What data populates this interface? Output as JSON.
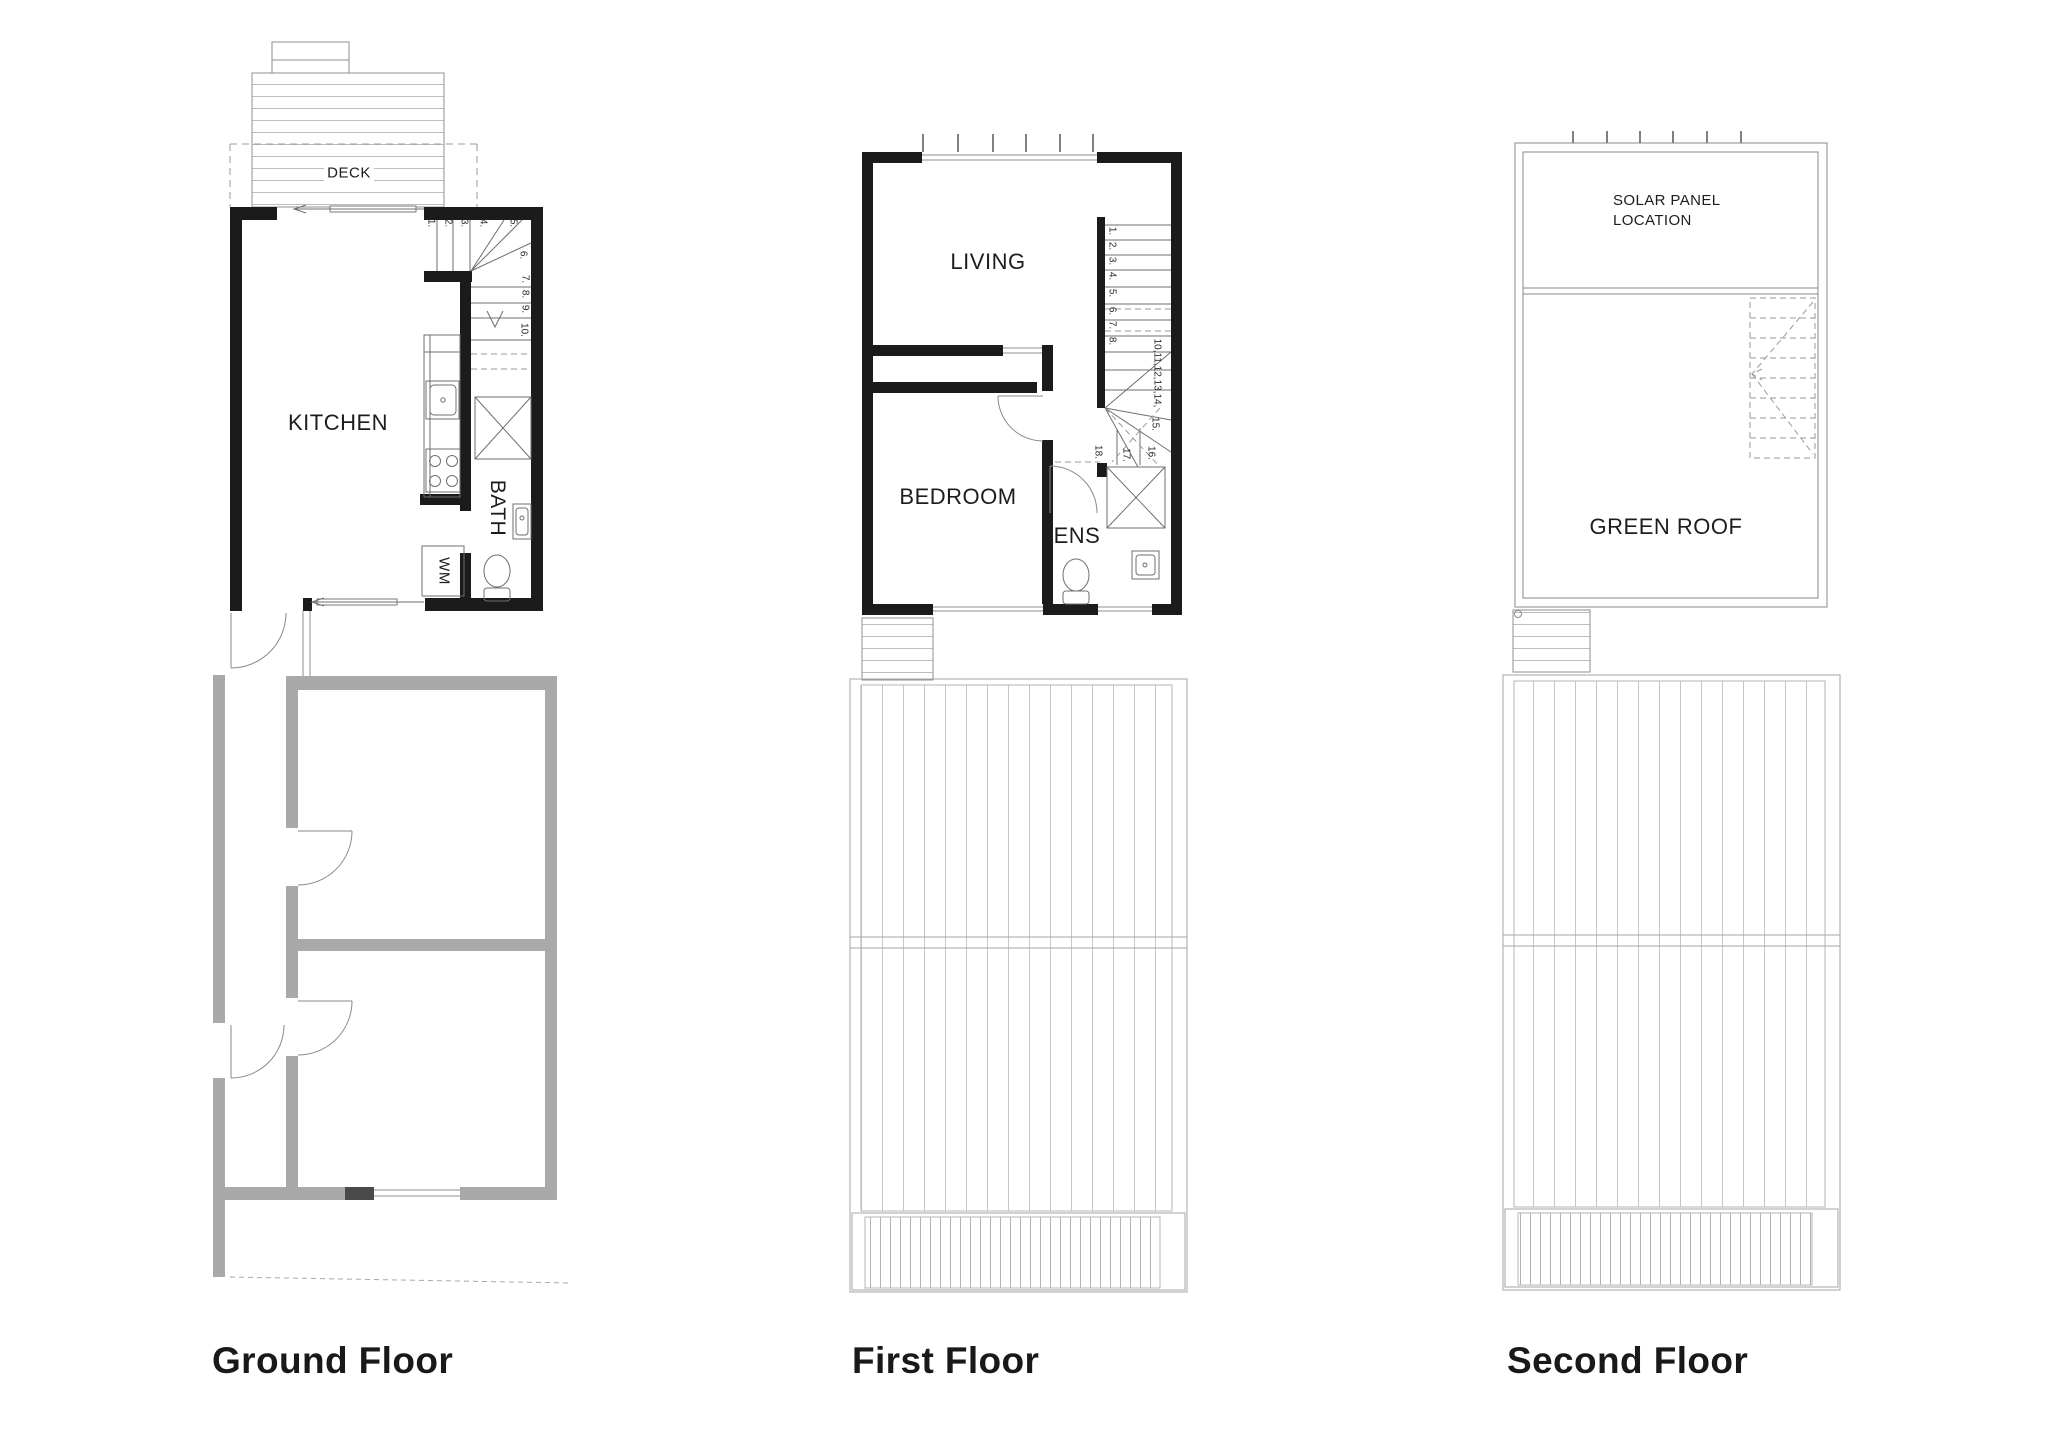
{
  "floors": {
    "ground": {
      "title": "Ground Floor",
      "labels": {
        "deck": "DECK",
        "kitchen": "KITCHEN",
        "bath": "BATH",
        "wm": "WM"
      },
      "stair_numbers": [
        "1.",
        "2.",
        "3.",
        "4.",
        "5.",
        "6.",
        "7.",
        "8.",
        "9.",
        "10."
      ]
    },
    "first": {
      "title": "First Floor",
      "labels": {
        "living": "LIVING",
        "bedroom": "BEDROOM",
        "ens": "ENS"
      },
      "stair_numbers": [
        "1.",
        "2.",
        "3.",
        "4.",
        "5.",
        "6.",
        "7.",
        "8."
      ],
      "stair_mid_run": "10,11,12,13,14,",
      "stair_lower_numbers": [
        "15.",
        "16.",
        "17.",
        "18."
      ]
    },
    "second": {
      "title": "Second Floor",
      "labels": {
        "solar_line1": "SOLAR PANEL",
        "solar_line2": "LOCATION",
        "green_roof": "GREEN ROOF"
      }
    }
  },
  "colors": {
    "new_walls": "#1b1b1b",
    "existing_walls": "#a9a9a9",
    "fixture_lines": "#6f6f6f",
    "roof_lines": "#c4c4c4",
    "background": "#ffffff"
  }
}
